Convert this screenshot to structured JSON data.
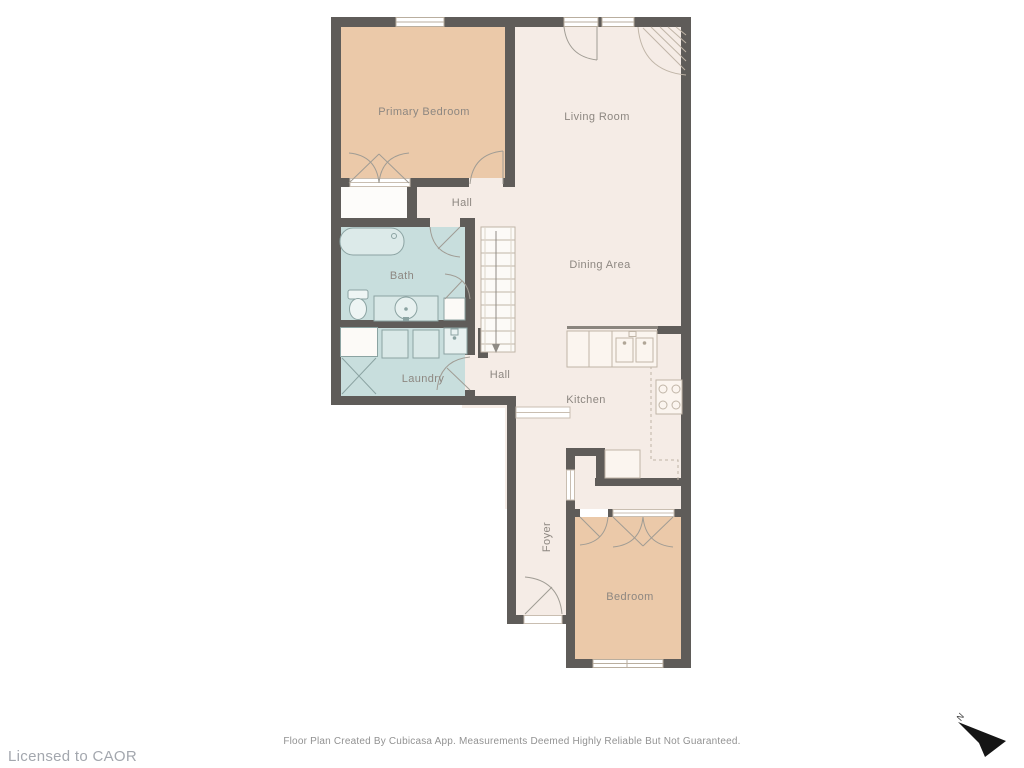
{
  "rooms": [
    {
      "label": "Primary Bedroom"
    },
    {
      "label": "Living Room"
    },
    {
      "label": "Hall"
    },
    {
      "label": "Bath"
    },
    {
      "label": "Dining Area"
    },
    {
      "label": "Laundry"
    },
    {
      "label": "Hall"
    },
    {
      "label": "Kitchen"
    },
    {
      "label": "Foyer"
    },
    {
      "label": "Bedroom"
    }
  ],
  "footer": {
    "license": "Licensed to CAOR",
    "disclaimer": "Floor Plan Created By Cubicasa App. Measurements Deemed Highly Reliable But Not Guaranteed."
  },
  "compass": {
    "label": "N"
  },
  "colors": {
    "background": "#ffffff",
    "wall": "#5f5c59",
    "floor": "#f5ece6",
    "bedroom_floor": "#ebc9a9",
    "wet_floor": "#c8dedd"
  }
}
